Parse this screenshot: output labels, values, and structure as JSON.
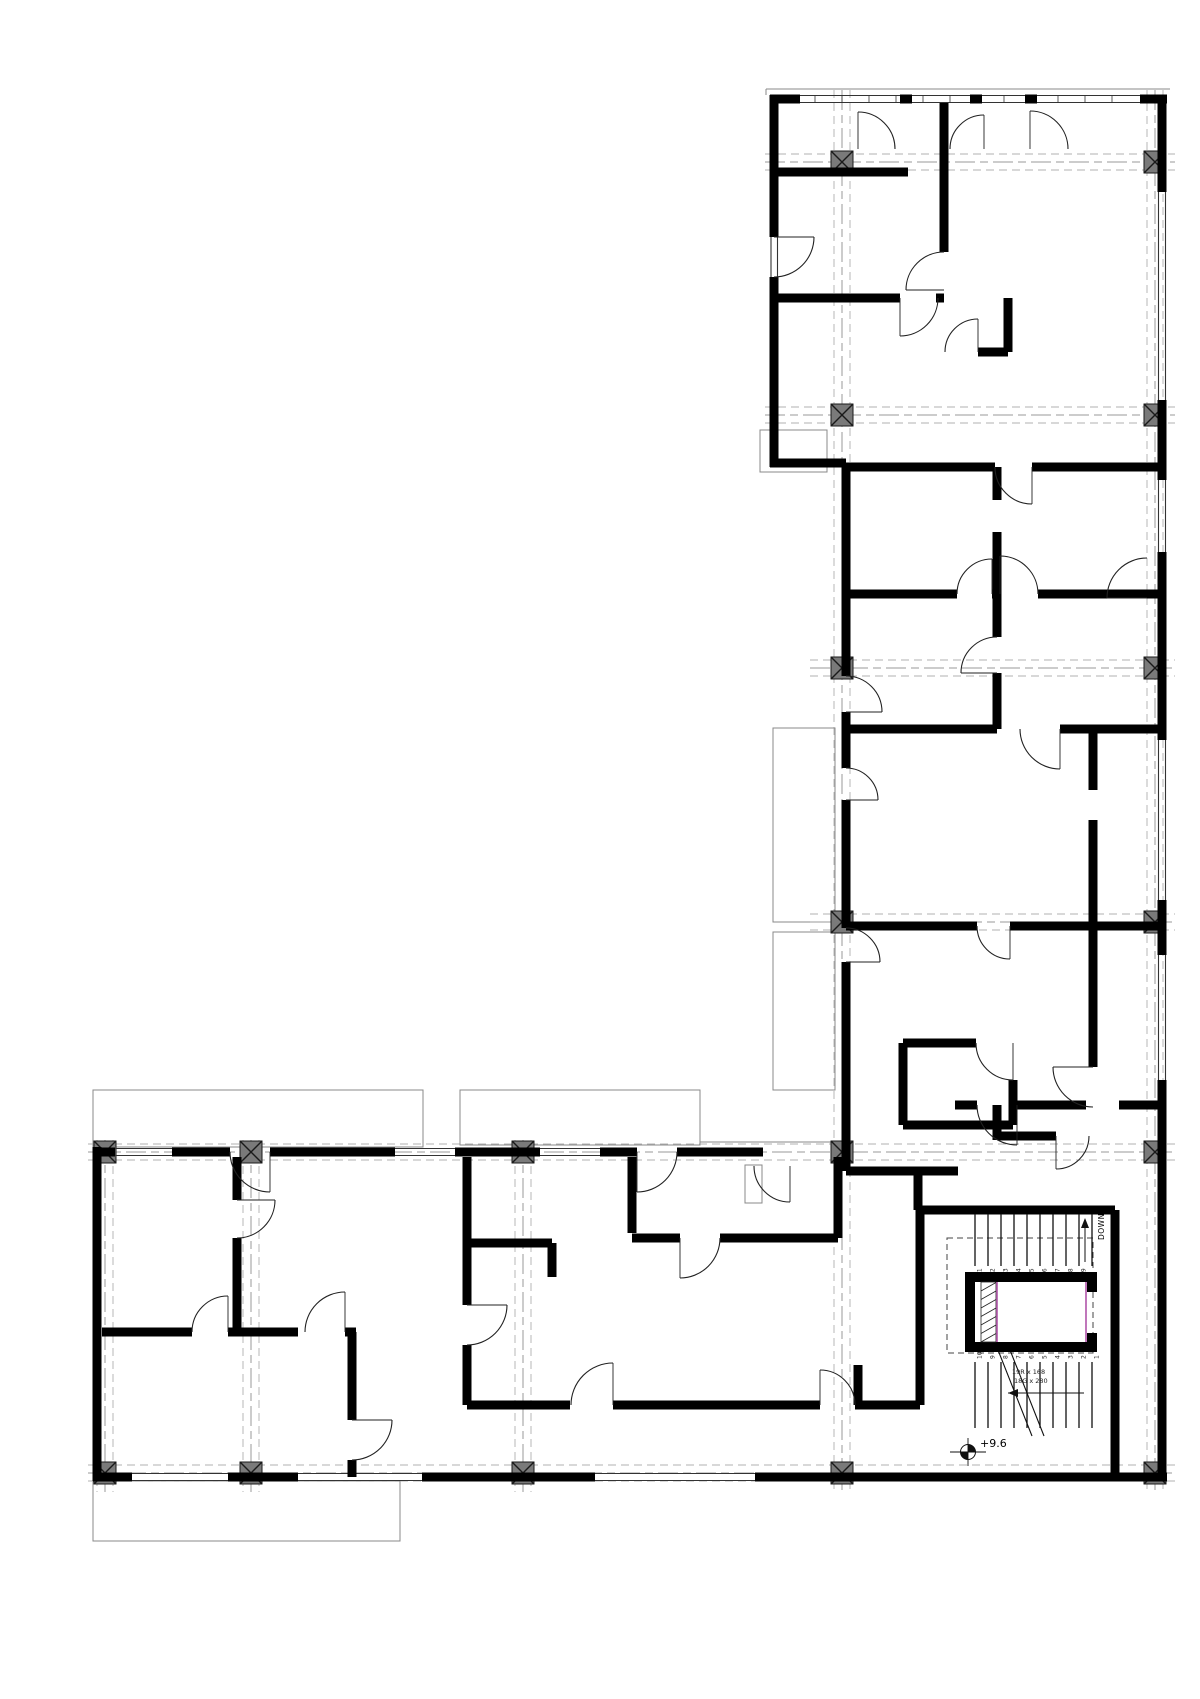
{
  "labels": {
    "down": "DOWN",
    "level": "+9.6",
    "stair_spec_line1": "19R x 168",
    "stair_spec_line2": "18G x 280"
  },
  "stairs": {
    "upper_flight_treads": [
      "11",
      "12",
      "13",
      "14",
      "15",
      "16",
      "17",
      "18",
      "19"
    ],
    "lower_flight_treads": [
      "10",
      "9",
      "8",
      "7",
      "6",
      "5",
      "4",
      "3",
      "2",
      "1"
    ]
  },
  "colors": {
    "wall": "#000000",
    "thin_outline": "#888888",
    "window_line": "#333333",
    "grid_line": "#999999",
    "column_fill": "#7a7a7a",
    "column_stroke": "#1a1a1a",
    "elevator_accent": "#b155aa",
    "background": "#ffffff"
  }
}
